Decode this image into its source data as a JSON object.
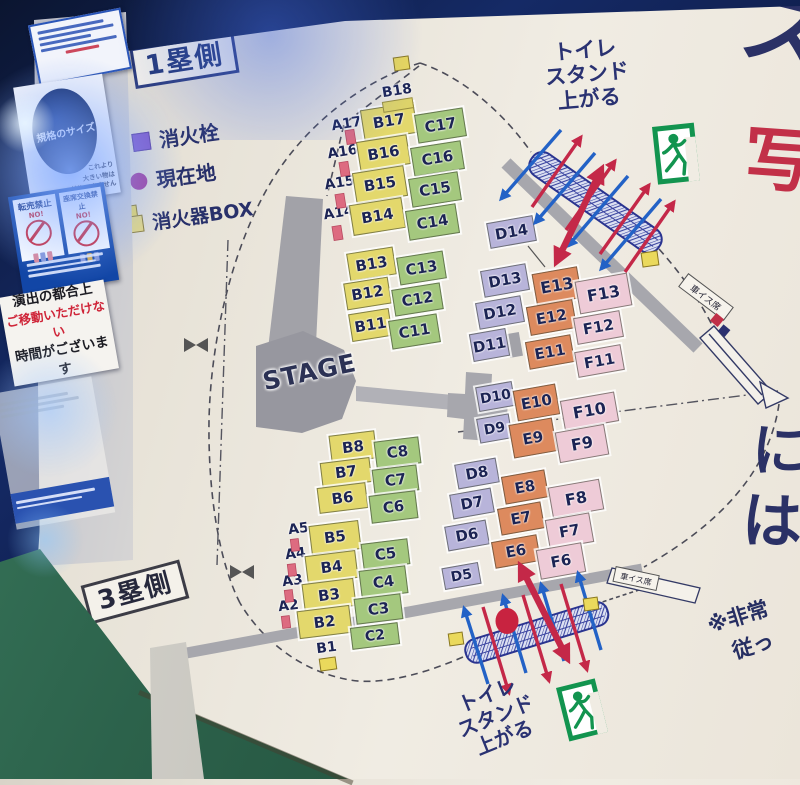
{
  "colors": {
    "seat-b": "#e3d86c",
    "seat-c": "#a4c87e",
    "seat-d": "#b8b4da",
    "seat-e": "#dd8a5e",
    "seat-f": "#eecbd7",
    "seat-text": "#1c2454",
    "arrow-red": "#c42848",
    "arrow-blue": "#2362c6",
    "exit-green": "#12944f",
    "legend-hydrant": "#7e57c9",
    "legend-location": "#a13898",
    "legend-extinguisher-box": "#e8da7e",
    "current-location": "#c82340"
  },
  "signs": {
    "size_sign": {
      "circle_label": "規格のサイズ",
      "caption_lines": [
        "これより",
        "大きい物は",
        "持込できません"
      ]
    },
    "prohibition_sign": {
      "left_title": "転売禁止",
      "right_title": "座席交換禁止",
      "no_label": "NO!"
    },
    "notice_sign": {
      "lines": [
        "演出の都合上",
        "ご移動いただけない",
        "時間がございます"
      ]
    }
  },
  "map": {
    "side_label_first_base": "1塁側",
    "side_label_third_base": "3塁側",
    "stage_label": "STAGE",
    "legend": [
      {
        "symbol": "square",
        "label": "消火栓"
      },
      {
        "symbol": "circle",
        "label": "現在地"
      },
      {
        "symbol": "square",
        "label": "消火器BOX"
      }
    ],
    "toilet_stand_note_top": [
      "トイレ",
      "スタンド",
      "上がる"
    ],
    "toilet_stand_note_bottom": [
      "トイレ",
      "スタンド",
      "上がる"
    ],
    "emergency_note_lines": [
      "※非常",
      "従っ"
    ],
    "ramp_label": "車イス席",
    "partial_right_text": {
      "top": "ス",
      "red": "写",
      "mid_a": "に",
      "mid_b": "は"
    },
    "seat_blocks": [
      {
        "label": "B18",
        "kind": "text"
      },
      {
        "label": "A17",
        "kind": "text"
      },
      {
        "label": "B17",
        "kind": "block"
      },
      {
        "label": "C17",
        "kind": "block"
      },
      {
        "label": "A16",
        "kind": "text"
      },
      {
        "label": "B16",
        "kind": "block"
      },
      {
        "label": "C16",
        "kind": "block"
      },
      {
        "label": "A15",
        "kind": "text"
      },
      {
        "label": "B15",
        "kind": "block"
      },
      {
        "label": "C15",
        "kind": "block"
      },
      {
        "label": "A14",
        "kind": "text"
      },
      {
        "label": "B14",
        "kind": "block"
      },
      {
        "label": "C14",
        "kind": "block"
      },
      {
        "label": "B13",
        "kind": "block"
      },
      {
        "label": "C13",
        "kind": "block"
      },
      {
        "label": "B12",
        "kind": "block"
      },
      {
        "label": "C12",
        "kind": "block"
      },
      {
        "label": "B11",
        "kind": "block"
      },
      {
        "label": "C11",
        "kind": "block"
      },
      {
        "label": "D14",
        "kind": "block"
      },
      {
        "label": "D13",
        "kind": "block"
      },
      {
        "label": "E13",
        "kind": "block"
      },
      {
        "label": "F13",
        "kind": "block"
      },
      {
        "label": "D12",
        "kind": "block"
      },
      {
        "label": "E12",
        "kind": "block"
      },
      {
        "label": "F12",
        "kind": "block"
      },
      {
        "label": "D11",
        "kind": "block"
      },
      {
        "label": "E11",
        "kind": "block"
      },
      {
        "label": "F11",
        "kind": "block"
      },
      {
        "label": "D10",
        "kind": "block"
      },
      {
        "label": "E10",
        "kind": "block"
      },
      {
        "label": "F10",
        "kind": "block"
      },
      {
        "label": "D9",
        "kind": "block"
      },
      {
        "label": "E9",
        "kind": "block"
      },
      {
        "label": "F9",
        "kind": "block"
      },
      {
        "label": "D8",
        "kind": "block"
      },
      {
        "label": "E8",
        "kind": "block"
      },
      {
        "label": "F8",
        "kind": "block"
      },
      {
        "label": "D7",
        "kind": "block"
      },
      {
        "label": "E7",
        "kind": "block"
      },
      {
        "label": "F7",
        "kind": "block"
      },
      {
        "label": "D6",
        "kind": "block"
      },
      {
        "label": "E6",
        "kind": "block"
      },
      {
        "label": "F6",
        "kind": "block"
      },
      {
        "label": "D5",
        "kind": "block"
      },
      {
        "label": "B8",
        "kind": "block"
      },
      {
        "label": "C8",
        "kind": "block"
      },
      {
        "label": "B7",
        "kind": "block"
      },
      {
        "label": "C7",
        "kind": "block"
      },
      {
        "label": "B6",
        "kind": "block"
      },
      {
        "label": "C6",
        "kind": "block"
      },
      {
        "label": "A5",
        "kind": "text"
      },
      {
        "label": "B5",
        "kind": "block"
      },
      {
        "label": "C5",
        "kind": "block"
      },
      {
        "label": "A4",
        "kind": "text"
      },
      {
        "label": "B4",
        "kind": "block"
      },
      {
        "label": "C4",
        "kind": "block"
      },
      {
        "label": "A3",
        "kind": "text"
      },
      {
        "label": "B3",
        "kind": "block"
      },
      {
        "label": "C3",
        "kind": "block"
      },
      {
        "label": "A2",
        "kind": "text"
      },
      {
        "label": "B2",
        "kind": "block"
      },
      {
        "label": "C2",
        "kind": "block"
      },
      {
        "label": "B1",
        "kind": "text"
      }
    ]
  }
}
